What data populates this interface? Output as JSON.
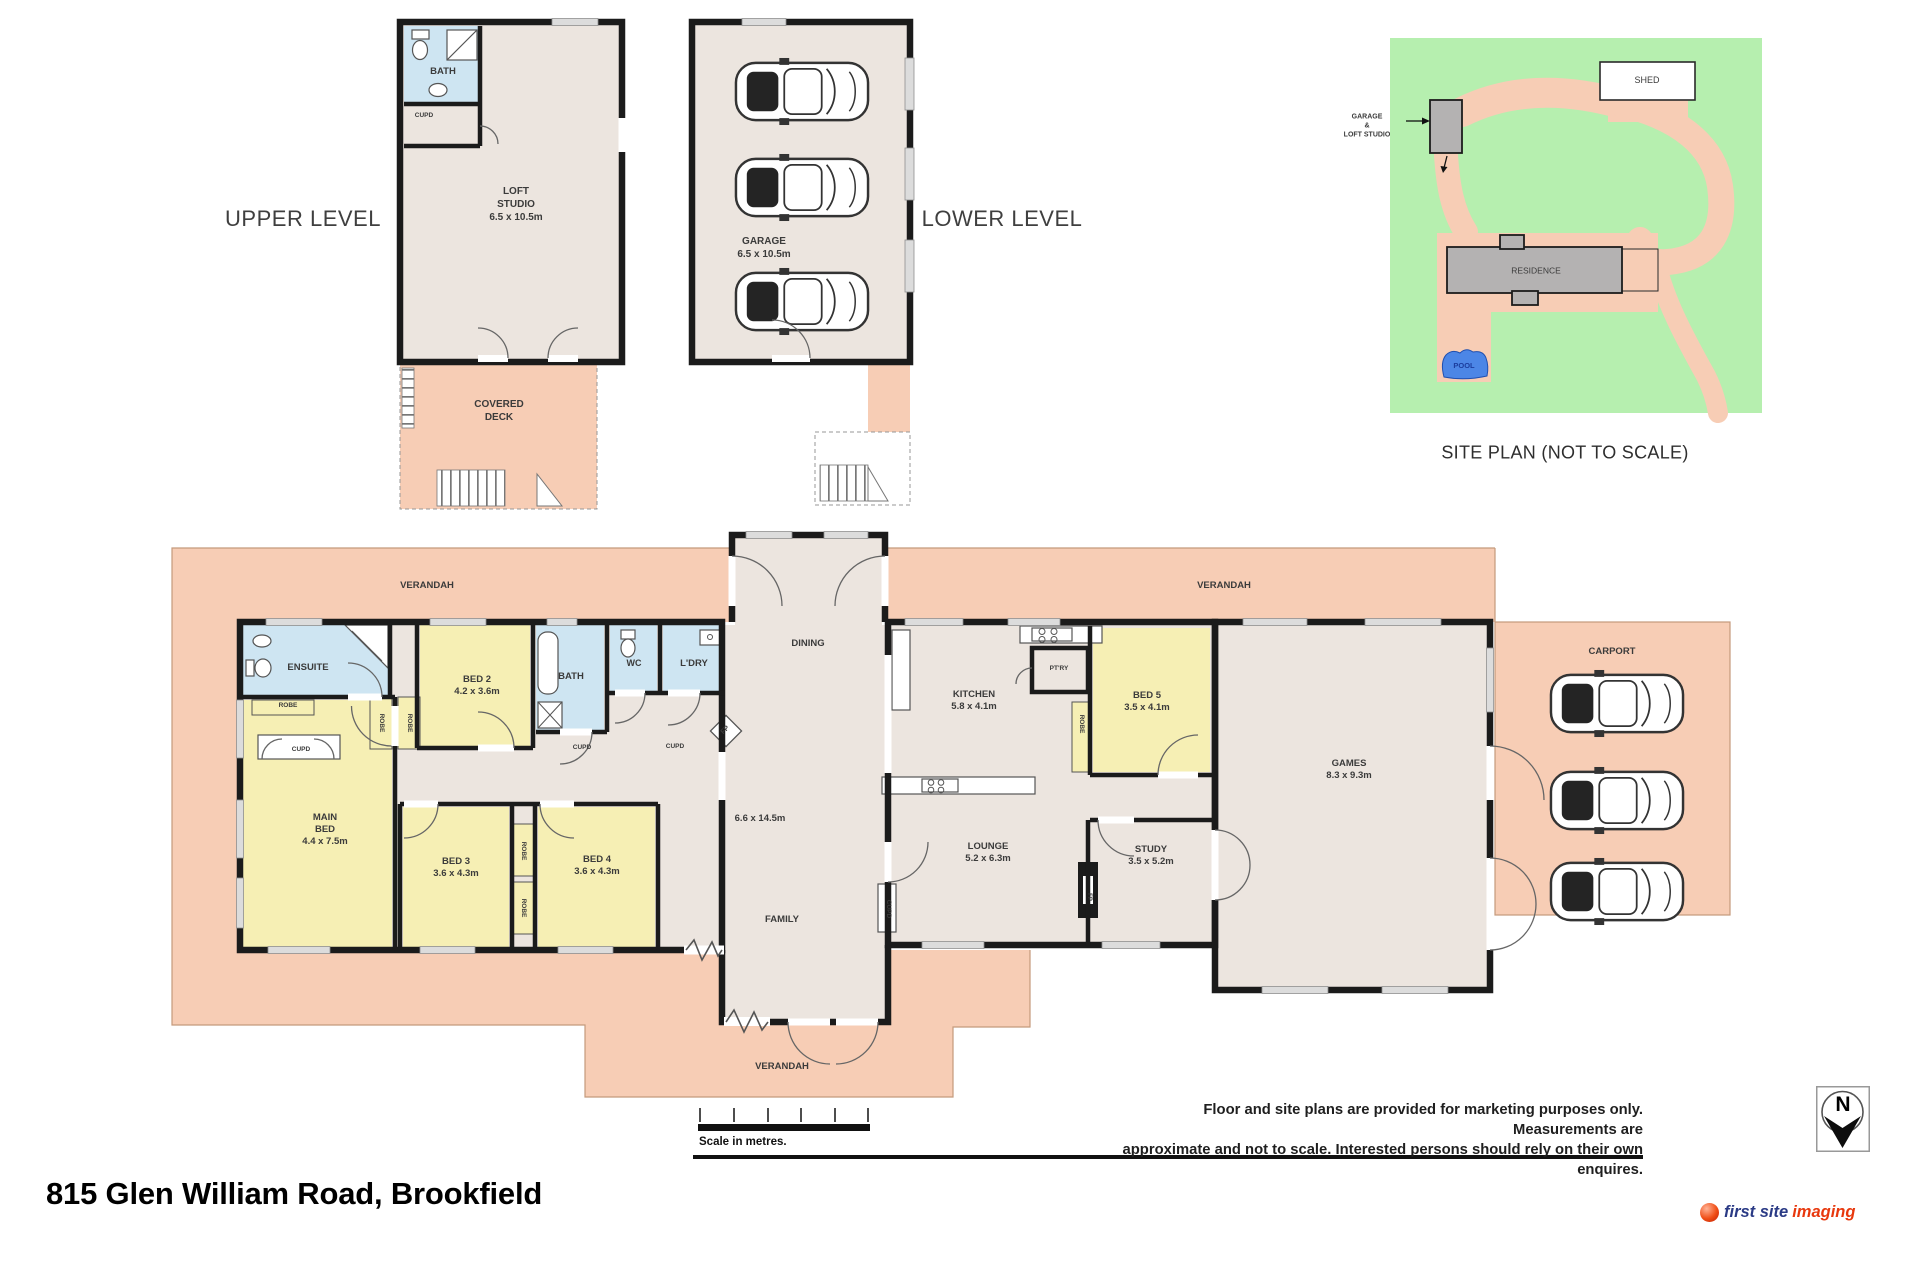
{
  "colors": {
    "verandah": "#F7CDB5",
    "floor": "#ECE5DF",
    "bedroom": "#F6EFB4",
    "wet": "#CEE5F2",
    "wall": "#1B1B1B",
    "site_green": "#B6EFAF",
    "building": "#B4B2B2",
    "pool": "#4C86E6",
    "logo_blue": "#2A3A85",
    "logo_red": "#E8380D"
  },
  "footer": {
    "address": "815 Glen William Road, Brookfield",
    "scale_label": "Scale in metres.",
    "disclaimer_line1": "Floor and site plans are provided for marketing purposes only. Measurements are",
    "disclaimer_line2": "approximate and not to scale. Interested persons should rely on their own enquires.",
    "north_letter": "N",
    "logo_word1": "first site",
    "logo_word2": "imaging"
  },
  "plan_labels": [
    {
      "id": "upper-level-label",
      "lines": [
        "UPPER LEVEL"
      ],
      "x": 303,
      "y": 219,
      "size": 22,
      "w": 400,
      "ls": 0.5,
      "color": "#3f3f3f"
    },
    {
      "id": "lower-level-label",
      "lines": [
        "LOWER LEVEL"
      ],
      "x": 1002,
      "y": 219,
      "size": 22,
      "w": 400,
      "ls": 0.5,
      "color": "#3f3f3f"
    },
    {
      "id": "loft-bath-label",
      "lines": [
        "BATH"
      ],
      "x": 443,
      "y": 72,
      "size": 9.5
    },
    {
      "id": "loft-cupd-label",
      "lines": [
        "CUPD"
      ],
      "x": 424,
      "y": 116,
      "size": 6.5
    },
    {
      "id": "loft-studio-label",
      "lines": [
        "LOFT",
        "STUDIO",
        "6.5 x 10.5m"
      ],
      "x": 516,
      "y": 205,
      "size": 10
    },
    {
      "id": "covered-deck-label",
      "lines": [
        "COVERED",
        "DECK"
      ],
      "x": 499,
      "y": 412,
      "size": 10
    },
    {
      "id": "garage-label",
      "lines": [
        "GARAGE",
        "6.5 x 10.5m"
      ],
      "x": 764,
      "y": 249,
      "size": 10
    },
    {
      "id": "shed-label",
      "lines": [
        "SHED"
      ],
      "x": 1647,
      "y": 81,
      "size": 9,
      "w": 400
    },
    {
      "id": "siteplan-garage-pointer",
      "lines": [
        "GARAGE",
        "&",
        "LOFT STUDIO"
      ],
      "x": 1367,
      "y": 127,
      "size": 7
    },
    {
      "id": "residence-label",
      "lines": [
        "RESIDENCE"
      ],
      "x": 1536,
      "y": 271,
      "size": 8.5,
      "w": 400
    },
    {
      "id": "pool-label",
      "lines": [
        "POOL"
      ],
      "x": 1464,
      "y": 366,
      "size": 7.5,
      "color": "#1c3e9e"
    },
    {
      "id": "siteplan-title",
      "lines": [
        "SITE PLAN (NOT TO SCALE)"
      ],
      "x": 1565,
      "y": 453,
      "size": 18,
      "w": 400,
      "ls": 0.3,
      "color": "#2e2e2e"
    },
    {
      "id": "verandah-top-left-label",
      "lines": [
        "VERANDAH"
      ],
      "x": 427,
      "y": 586,
      "size": 9.5
    },
    {
      "id": "verandah-top-right-label",
      "lines": [
        "VERANDAH"
      ],
      "x": 1224,
      "y": 586,
      "size": 9.5
    },
    {
      "id": "verandah-bottom-label",
      "lines": [
        "VERANDAH"
      ],
      "x": 782,
      "y": 1067,
      "size": 9.5
    },
    {
      "id": "carport-label",
      "lines": [
        "CARPORT"
      ],
      "x": 1612,
      "y": 652,
      "size": 9.5
    },
    {
      "id": "ensuite-label",
      "lines": [
        "ENSUITE"
      ],
      "x": 308,
      "y": 668,
      "size": 9.5
    },
    {
      "id": "bed2-label",
      "lines": [
        "BED 2",
        "4.2 x 3.6m"
      ],
      "x": 477,
      "y": 686,
      "size": 9.5
    },
    {
      "id": "bath-label",
      "lines": [
        "BATH"
      ],
      "x": 571,
      "y": 677,
      "size": 9.5
    },
    {
      "id": "wc-label",
      "lines": [
        "WC"
      ],
      "x": 634,
      "y": 664,
      "size": 9
    },
    {
      "id": "ldry-label",
      "lines": [
        "L'DRY"
      ],
      "x": 694,
      "y": 664,
      "size": 9.5
    },
    {
      "id": "main-bed-label",
      "lines": [
        "MAIN",
        "BED",
        "4.4 x 7.5m"
      ],
      "x": 325,
      "y": 830,
      "size": 9.5
    },
    {
      "id": "bed3-label",
      "lines": [
        "BED 3",
        "3.6 x 4.3m"
      ],
      "x": 456,
      "y": 868,
      "size": 9.5
    },
    {
      "id": "bed4-label",
      "lines": [
        "BED 4",
        "3.6 x 4.3m"
      ],
      "x": 597,
      "y": 866,
      "size": 9.5
    },
    {
      "id": "dining-label",
      "lines": [
        "DINING"
      ],
      "x": 808,
      "y": 644,
      "size": 9.5
    },
    {
      "id": "family-label",
      "lines": [
        "FAMILY"
      ],
      "x": 782,
      "y": 920,
      "size": 9.5
    },
    {
      "id": "family-dims-label",
      "lines": [
        "6.6 x 14.5m"
      ],
      "x": 760,
      "y": 819,
      "size": 9.5
    },
    {
      "id": "kitchen-label",
      "lines": [
        "KITCHEN",
        "5.8 x 4.1m"
      ],
      "x": 974,
      "y": 701,
      "size": 9.5
    },
    {
      "id": "ptry-label",
      "lines": [
        "PT'RY"
      ],
      "x": 1059,
      "y": 669,
      "size": 6.5
    },
    {
      "id": "bed5-label",
      "lines": [
        "BED 5",
        "3.5 x 4.1m"
      ],
      "x": 1147,
      "y": 702,
      "size": 9.5
    },
    {
      "id": "lounge-label",
      "lines": [
        "LOUNGE",
        "5.2 x 6.3m"
      ],
      "x": 988,
      "y": 853,
      "size": 9.5
    },
    {
      "id": "study-label",
      "lines": [
        "STUDY",
        "3.5 x 5.2m"
      ],
      "x": 1151,
      "y": 856,
      "size": 9.5
    },
    {
      "id": "games-label",
      "lines": [
        "GAMES",
        "8.3 x 9.3m"
      ],
      "x": 1349,
      "y": 770,
      "size": 9.5
    },
    {
      "id": "hall-cupd-label",
      "lines": [
        "CUPD"
      ],
      "x": 301,
      "y": 750,
      "size": 6.5
    },
    {
      "id": "bath-cupd-label",
      "lines": [
        "CUPD"
      ],
      "x": 582,
      "y": 748,
      "size": 6.5
    },
    {
      "id": "ldry-cupd-label",
      "lines": [
        "CUPD"
      ],
      "x": 675,
      "y": 747,
      "size": 6.5
    },
    {
      "id": "family-cupd-label",
      "lines": [
        "CUPD"
      ],
      "x": 888,
      "y": 909,
      "size": 6.5,
      "rotate": 90
    },
    {
      "id": "mainbed-robe-label",
      "lines": [
        "ROBE"
      ],
      "x": 288,
      "y": 706,
      "size": 6.5
    },
    {
      "id": "robe-a-label",
      "lines": [
        "ROBE"
      ],
      "x": 381,
      "y": 723,
      "size": 6.5,
      "rotate": 90
    },
    {
      "id": "robe-b-label",
      "lines": [
        "ROBE"
      ],
      "x": 409,
      "y": 723,
      "size": 6.5,
      "rotate": 90
    },
    {
      "id": "robe-c-label",
      "lines": [
        "ROBE"
      ],
      "x": 523,
      "y": 851,
      "size": 6.5,
      "rotate": 90
    },
    {
      "id": "robe-d-label",
      "lines": [
        "ROBE"
      ],
      "x": 523,
      "y": 908,
      "size": 6.5,
      "rotate": 90
    },
    {
      "id": "bed5-robe-label",
      "lines": [
        "ROBE"
      ],
      "x": 1081,
      "y": 724,
      "size": 6.5,
      "rotate": 90
    },
    {
      "id": "dining-fp-label",
      "lines": [
        "FP"
      ],
      "x": 726,
      "y": 731,
      "size": 7,
      "rotate": -45
    },
    {
      "id": "lounge-fp-label",
      "lines": [
        "FP"
      ],
      "x": 1088,
      "y": 897,
      "size": 6,
      "rotate": 90,
      "color": "#333"
    }
  ]
}
